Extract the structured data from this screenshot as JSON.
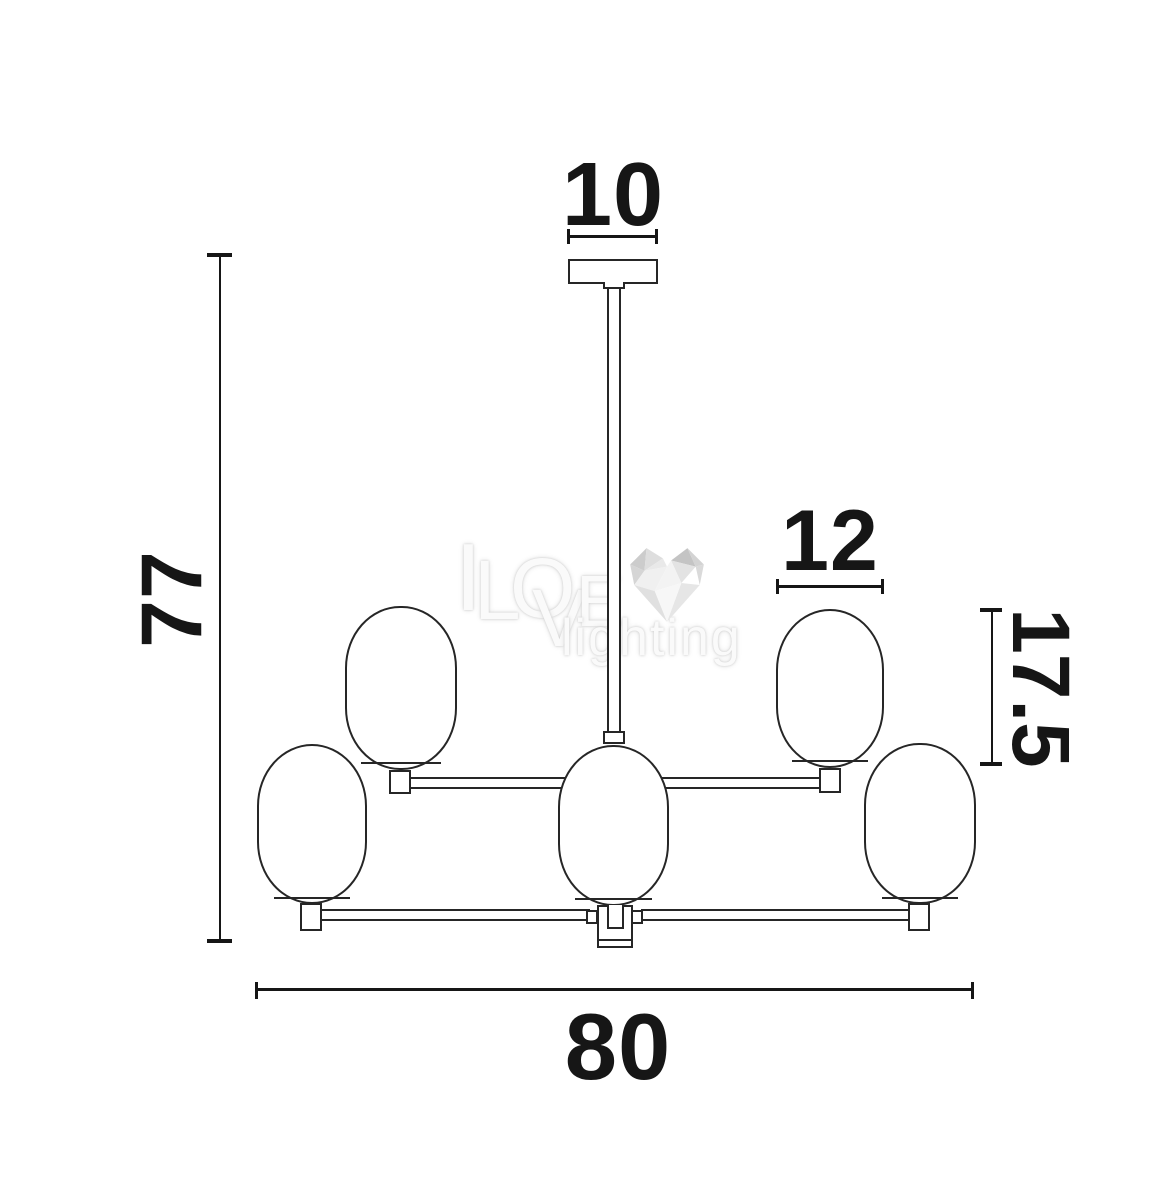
{
  "fixture": {
    "description": "chandelier technical line drawing",
    "visible_shades": 5,
    "shade_shape": "capsule"
  },
  "dimensions": {
    "canopy_width": {
      "label": "10"
    },
    "overall_height": {
      "label": "77"
    },
    "shade_width": {
      "label": "12"
    },
    "shade_height": {
      "label": "17.5"
    },
    "overall_width": {
      "label": "80"
    }
  },
  "watermark": {
    "letter_i": "I",
    "letter_l": "L",
    "letter_o": "O",
    "letter_v": "V",
    "letter_e": "E",
    "subtitle": "lighting",
    "heart_icon": "low-poly-heart"
  },
  "colors": {
    "background": "#ffffff",
    "drawing_line": "#262626",
    "dimension_line": "#161616",
    "watermark_text": "#fafafa",
    "watermark_halo": "#c9c9c9",
    "heart_grays": [
      "#c4c4c4",
      "#d6d6d6",
      "#e6e6e6",
      "#f4f4f4"
    ]
  }
}
